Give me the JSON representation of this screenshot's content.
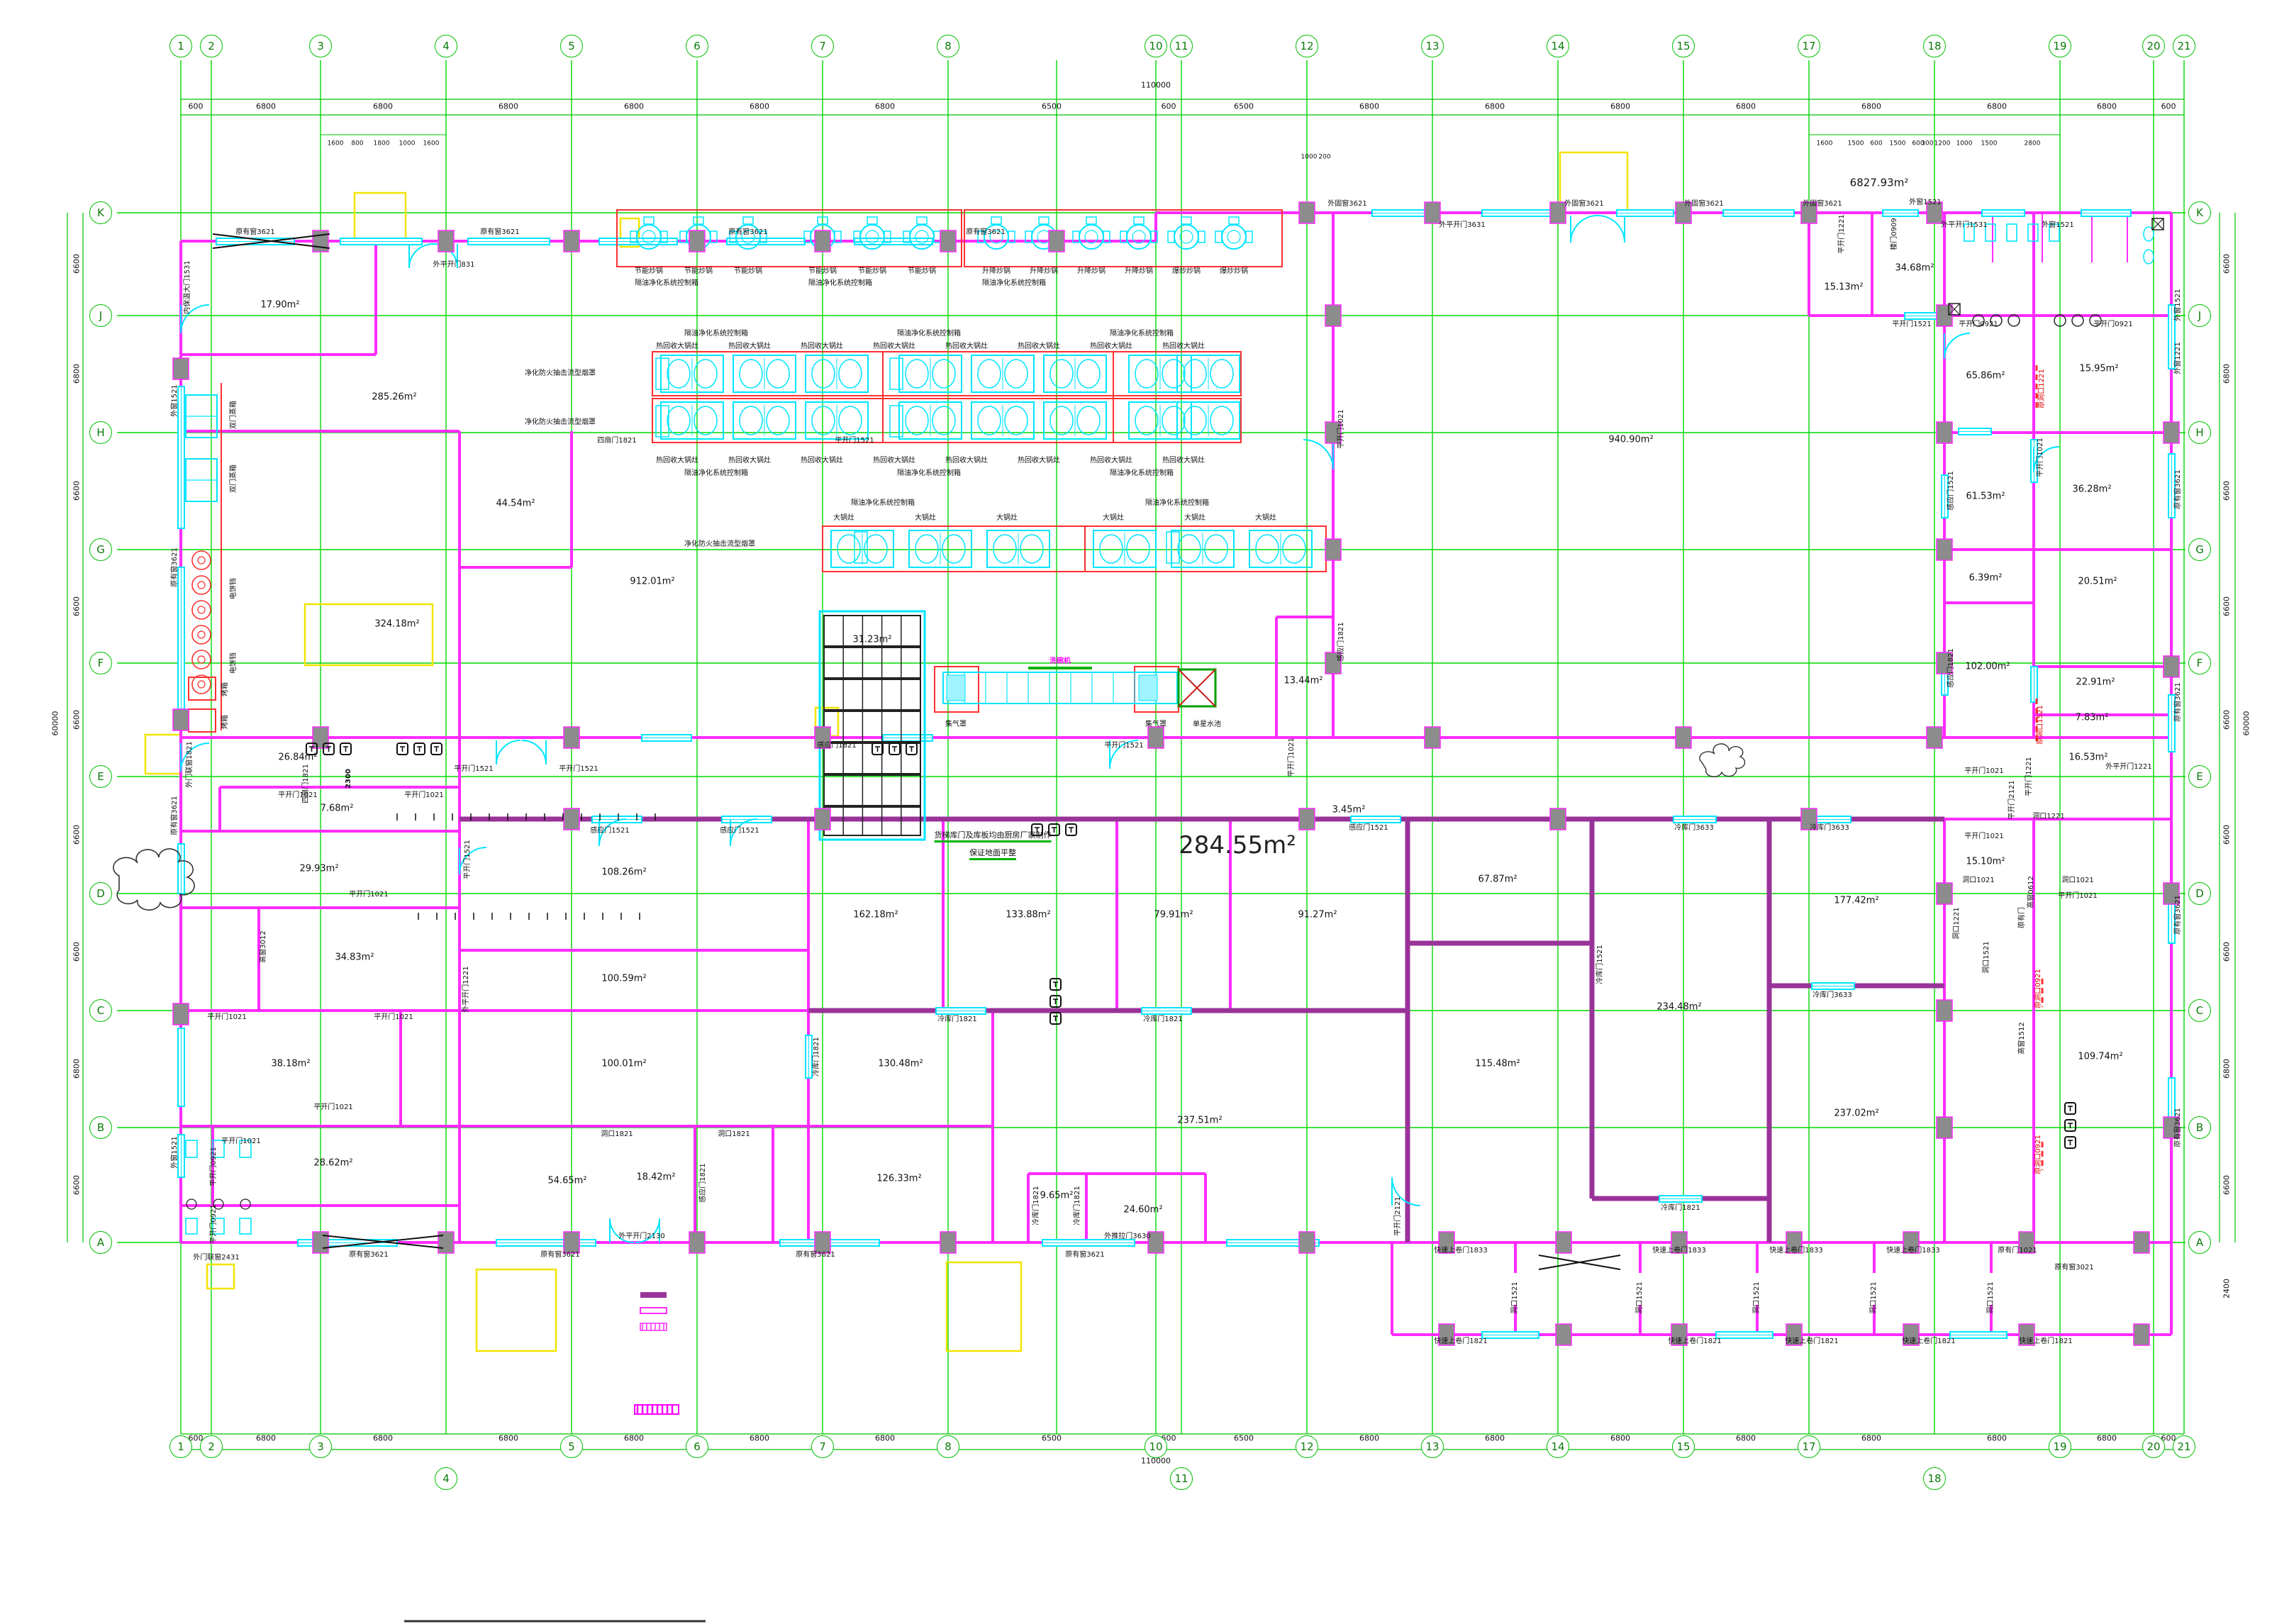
{
  "drawing": {
    "big_area_label": "284.55m²",
    "total_area_label": "6827.93m²",
    "note_line1": "货梯库门及库板均由厨房厂家制作",
    "note_line2": "保证地面平整",
    "overall_width_top": "110000",
    "overall_width_bottom": "110000",
    "overall_height_left": "60000",
    "overall_height_right": "60000",
    "corridor_width": "2300"
  },
  "grid": {
    "top_cols": [
      [
        "1",
        255
      ],
      [
        "2",
        298
      ],
      [
        "3",
        452
      ],
      [
        "4",
        629
      ],
      [
        "5",
        806
      ],
      [
        "6",
        983
      ],
      [
        "7",
        1160
      ],
      [
        "8",
        1337
      ],
      [
        "10",
        1630
      ],
      [
        "11",
        1666
      ],
      [
        "12",
        1843
      ],
      [
        "13",
        2020
      ],
      [
        "14",
        2197
      ],
      [
        "15",
        2374
      ],
      [
        "17",
        2551
      ],
      [
        "18",
        2728
      ],
      [
        "19",
        2905
      ],
      [
        "20",
        3037
      ],
      [
        "21",
        3080
      ]
    ],
    "bottom_cols": [
      [
        "1",
        255,
        2040
      ],
      [
        "2",
        298,
        2040
      ],
      [
        "3",
        452,
        2040
      ],
      [
        "4",
        629,
        2085
      ],
      [
        "5",
        806,
        2040
      ],
      [
        "6",
        983,
        2040
      ],
      [
        "7",
        1160,
        2040
      ],
      [
        "8",
        1337,
        2040
      ],
      [
        "10",
        1630,
        2040
      ],
      [
        "11",
        1666,
        2085
      ],
      [
        "12",
        1843,
        2040
      ],
      [
        "13",
        2020,
        2040
      ],
      [
        "14",
        2197,
        2040
      ],
      [
        "15",
        2374,
        2040
      ],
      [
        "17",
        2551,
        2040
      ],
      [
        "18",
        2728,
        2085
      ],
      [
        "19",
        2905,
        2040
      ],
      [
        "20",
        3037,
        2040
      ],
      [
        "21",
        3080,
        2040
      ]
    ],
    "left_rows": [
      [
        "K",
        300
      ],
      [
        "J",
        445
      ],
      [
        "H",
        610
      ],
      [
        "G",
        775
      ],
      [
        "F",
        935
      ],
      [
        "E",
        1095
      ],
      [
        "D",
        1260
      ],
      [
        "C",
        1425
      ],
      [
        "B",
        1590
      ],
      [
        "A",
        1752
      ]
    ],
    "right_rows": [
      [
        "K",
        300
      ],
      [
        "J",
        445
      ],
      [
        "H",
        610
      ],
      [
        "G",
        775
      ],
      [
        "F",
        935
      ],
      [
        "E",
        1095
      ],
      [
        "D",
        1260
      ],
      [
        "C",
        1425
      ],
      [
        "B",
        1590
      ],
      [
        "A",
        1752
      ]
    ]
  },
  "dims": {
    "top": [
      [
        "600",
        276
      ],
      [
        "6800",
        375
      ],
      [
        "6800",
        540
      ],
      [
        "6800",
        717
      ],
      [
        "6800",
        894
      ],
      [
        "6800",
        1071
      ],
      [
        "6800",
        1248
      ],
      [
        "6500",
        1483
      ],
      [
        "600",
        1648
      ],
      [
        "6500",
        1754
      ],
      [
        "6800",
        1931
      ],
      [
        "6800",
        2108
      ],
      [
        "6800",
        2285
      ],
      [
        "6800",
        2462
      ],
      [
        "6800",
        2639
      ],
      [
        "6800",
        2816
      ],
      [
        "6800",
        2971
      ],
      [
        "600",
        3058
      ]
    ],
    "bottom": [
      [
        "600",
        276
      ],
      [
        "6800",
        375
      ],
      [
        "6800",
        540
      ],
      [
        "6800",
        717
      ],
      [
        "6800",
        894
      ],
      [
        "6800",
        1071
      ],
      [
        "6800",
        1248
      ],
      [
        "6500",
        1483
      ],
      [
        "600",
        1648
      ],
      [
        "6500",
        1754
      ],
      [
        "6800",
        1931
      ],
      [
        "6800",
        2108
      ],
      [
        "6800",
        2285
      ],
      [
        "6800",
        2462
      ],
      [
        "6800",
        2639
      ],
      [
        "6800",
        2816
      ],
      [
        "6800",
        2971
      ],
      [
        "600",
        3058
      ]
    ],
    "sub_top_left": [
      [
        "1600",
        473
      ],
      [
        "800",
        504
      ],
      [
        "1800",
        538
      ],
      [
        "1000",
        574
      ],
      [
        "1600",
        608
      ]
    ],
    "sub_top_right": [
      [
        "1600",
        2573
      ],
      [
        "1500",
        2617
      ],
      [
        "600",
        2646
      ],
      [
        "1500",
        2676
      ],
      [
        "600",
        2705
      ],
      [
        "300",
        2718
      ],
      [
        "1200",
        2739
      ],
      [
        "1000",
        2770
      ],
      [
        "1500",
        2805
      ],
      [
        "2800",
        2866
      ]
    ],
    "sub_top_mid": [
      [
        "1000",
        1846
      ],
      [
        "200",
        1868
      ]
    ],
    "left": [
      [
        "6600",
        372
      ],
      [
        "6800",
        527
      ],
      [
        "6600",
        692
      ],
      [
        "6600",
        855
      ],
      [
        "6600",
        1015
      ],
      [
        "6600",
        1177
      ],
      [
        "6600",
        1342
      ],
      [
        "6800",
        1507
      ],
      [
        "6600",
        1671
      ]
    ],
    "right": [
      [
        "6600",
        372
      ],
      [
        "6800",
        527
      ],
      [
        "6600",
        692
      ],
      [
        "6600",
        855
      ],
      [
        "6600",
        1015
      ],
      [
        "6600",
        1177
      ],
      [
        "6600",
        1342
      ],
      [
        "6800",
        1507
      ],
      [
        "6600",
        1671
      ],
      [
        "2400",
        1817
      ]
    ]
  },
  "areas": [
    [
      "17.90m²",
      395,
      430
    ],
    [
      "285.26m²",
      556,
      560
    ],
    [
      "912.01m²",
      920,
      820
    ],
    [
      "44.54m²",
      727,
      710
    ],
    [
      "324.18m²",
      560,
      880
    ],
    [
      "31.23m²",
      1230,
      902
    ],
    [
      "940.90m²",
      2300,
      620
    ],
    [
      "13.44m²",
      1838,
      960
    ],
    [
      "3.45m²",
      1902,
      1142
    ],
    [
      "15.13m²",
      2600,
      405
    ],
    [
      "34.68m²",
      2700,
      378
    ],
    [
      "15.95m²",
      2960,
      520
    ],
    [
      "65.86m²",
      2800,
      530
    ],
    [
      "36.28m²",
      2950,
      690
    ],
    [
      "61.53m²",
      2800,
      700
    ],
    [
      "20.51m²",
      2958,
      820
    ],
    [
      "6.39m²",
      2800,
      815
    ],
    [
      "102.00m²",
      2803,
      940
    ],
    [
      "22.91m²",
      2955,
      962
    ],
    [
      "7.83m²",
      2950,
      1012
    ],
    [
      "16.53m²",
      2945,
      1068
    ],
    [
      "15.10m²",
      2800,
      1215
    ],
    [
      "26.84m²",
      420,
      1068
    ],
    [
      "7.68m²",
      475,
      1140
    ],
    [
      "29.93m²",
      450,
      1225
    ],
    [
      "34.83m²",
      500,
      1350
    ],
    [
      "38.18m²",
      410,
      1500
    ],
    [
      "28.62m²",
      470,
      1640
    ],
    [
      "54.65m²",
      800,
      1665
    ],
    [
      "18.42m²",
      925,
      1660
    ],
    [
      "108.26m²",
      880,
      1230
    ],
    [
      "100.59m²",
      880,
      1380
    ],
    [
      "100.01m²",
      880,
      1500
    ],
    [
      "162.18m²",
      1235,
      1290
    ],
    [
      "133.88m²",
      1450,
      1290
    ],
    [
      "79.91m²",
      1655,
      1290
    ],
    [
      "91.27m²",
      1858,
      1290
    ],
    [
      "67.87m²",
      2112,
      1240
    ],
    [
      "115.48m²",
      2112,
      1500
    ],
    [
      "234.48m²",
      2368,
      1420
    ],
    [
      "177.42m²",
      2618,
      1270
    ],
    [
      "237.02m²",
      2618,
      1570
    ],
    [
      "237.51m²",
      1692,
      1580
    ],
    [
      "130.48m²",
      1270,
      1500
    ],
    [
      "126.33m²",
      1268,
      1662
    ],
    [
      "9.65m²",
      1490,
      1686
    ],
    [
      "24.60m²",
      1612,
      1706
    ],
    [
      "109.74m²",
      2962,
      1490
    ]
  ],
  "doors": [
    [
      "原有窗3621",
      360,
      328
    ],
    [
      "原有窗3621",
      705,
      328
    ],
    [
      "原有窗3621",
      1055,
      328
    ],
    [
      "原有窗3621",
      1390,
      328
    ],
    [
      "外平开门831",
      640,
      374
    ],
    [
      "外固窗3621",
      1900,
      288
    ],
    [
      "外固窗3621",
      2234,
      288
    ],
    [
      "外固窗3621",
      2403,
      288
    ],
    [
      "外固窗3621",
      2570,
      288
    ],
    [
      "外平开门3631",
      2062,
      318
    ],
    [
      "外窗1521",
      2715,
      286
    ],
    [
      "外平开门1531",
      2770,
      318
    ],
    [
      "外窗1521",
      2902,
      318
    ],
    [
      "外窗1521",
      3072,
      430,
      -90
    ],
    [
      "外窗1221",
      3072,
      505,
      -90
    ],
    [
      "原有窗3621",
      3072,
      690,
      -90
    ],
    [
      "原有窗3621",
      3072,
      990,
      -90
    ],
    [
      "原有窗3621",
      3072,
      1290,
      -90
    ],
    [
      "原有窗3621",
      3072,
      1590,
      -90
    ],
    [
      "内保温大门1531",
      265,
      405,
      -90
    ],
    [
      "外窗1521",
      247,
      565,
      -90
    ],
    [
      "原有窗3621",
      247,
      800,
      -90
    ],
    [
      "原有窗3621",
      247,
      1150,
      -90
    ],
    [
      "外窗1521",
      247,
      1625,
      -90
    ],
    [
      "外门联窗1821",
      268,
      1078,
      -90
    ],
    [
      "平开门0921",
      302,
      1645,
      -90
    ],
    [
      "平开门0921",
      302,
      1726,
      -90
    ],
    [
      "四扇门1821",
      432,
      1105,
      -90
    ],
    [
      "平开门1521",
      668,
      1085
    ],
    [
      "平开门1521",
      816,
      1085
    ],
    [
      "感应门1821",
      1180,
      1052
    ],
    [
      "平开门1521",
      1585,
      1052
    ],
    [
      "平开门1021",
      1822,
      1068,
      -90
    ],
    [
      "感应门1521",
      860,
      1172
    ],
    [
      "感应门1521",
      1043,
      1172
    ],
    [
      "感应门1521",
      1930,
      1168
    ],
    [
      "四扇门1821",
      870,
      622
    ],
    [
      "平开门1521",
      1205,
      622
    ],
    [
      "平开门1521",
      660,
      1212,
      -90
    ],
    [
      "平开门1021",
      1892,
      605,
      -90
    ],
    [
      "感应门1821",
      1892,
      905,
      -90
    ],
    [
      "平开门1021",
      420,
      1122
    ],
    [
      "平开门1021",
      598,
      1122
    ],
    [
      "平开门1021",
      320,
      1435
    ],
    [
      "平开门1021",
      555,
      1435
    ],
    [
      "平开门1021",
      470,
      1562
    ],
    [
      "平开门1021",
      340,
      1610
    ],
    [
      "高窗3012",
      372,
      1335,
      -90
    ],
    [
      "外平开门1221",
      658,
      1395,
      -90
    ],
    [
      "平开门1021",
      520,
      1262
    ],
    [
      "洞口1821",
      870,
      1600
    ],
    [
      "洞口1821",
      1035,
      1600
    ],
    [
      "感应门1821",
      992,
      1668,
      -90
    ],
    [
      "冷库门1821",
      1350,
      1438
    ],
    [
      "冷库门1821",
      1640,
      1438
    ],
    [
      "冷库门1821",
      1152,
      1490,
      -90
    ],
    [
      "冷库门1521",
      2257,
      1360,
      -90
    ],
    [
      "冷库门3633",
      2389,
      1168
    ],
    [
      "冷库门3633",
      2580,
      1168
    ],
    [
      "冷库门3633",
      2584,
      1404
    ],
    [
      "冷库门1821",
      2370,
      1704
    ],
    [
      "冷库门1821",
      1462,
      1700,
      -90
    ],
    [
      "冷库门1821",
      1520,
      1700,
      -90
    ],
    [
      "外推拉门3630",
      1590,
      1744
    ],
    [
      "平开门2121",
      1972,
      1715,
      -90
    ],
    [
      "平开门1521",
      2696,
      458
    ],
    [
      "平开门1221",
      2598,
      330,
      -90
    ],
    [
      "楼门0909",
      2672,
      330,
      -90
    ],
    [
      "平开门0921",
      2790,
      458
    ],
    [
      "平开门0921",
      2980,
      458
    ],
    [
      "感应门1521",
      2752,
      692,
      -90
    ],
    [
      "感应门1821",
      2752,
      942,
      -90
    ],
    [
      "原洞口1221",
      2880,
      548,
      -90,
      "r"
    ],
    [
      "平开门1021",
      2878,
      645,
      -90
    ],
    [
      "原洞口1521",
      2878,
      1022,
      -90,
      "r"
    ],
    [
      "平开门1021",
      2798,
      1088
    ],
    [
      "洞口1221",
      2889,
      1152
    ],
    [
      "外平开门1221",
      3002,
      1082
    ],
    [
      "平开门1221",
      2862,
      1095,
      -90
    ],
    [
      "平开门2121",
      2838,
      1128,
      -90
    ],
    [
      "洞口1021",
      2790,
      1242
    ],
    [
      "洞口1021",
      2930,
      1242
    ],
    [
      "平开门1021",
      2930,
      1264
    ],
    [
      "平开门1021",
      2798,
      1180
    ],
    [
      "洞口1221",
      2760,
      1302,
      -90
    ],
    [
      "洞口1521",
      2802,
      1350,
      -90
    ],
    [
      "高窗0612",
      2865,
      1258,
      -90
    ],
    [
      "高窗1512",
      2852,
      1464,
      -90
    ],
    [
      "原有门",
      2852,
      1294,
      -90
    ],
    [
      "原洞口0921",
      2875,
      1394,
      -90,
      "r"
    ],
    [
      "原洞口0921",
      2875,
      1628,
      -90,
      "r"
    ],
    [
      "原有窗3621",
      520,
      1770
    ],
    [
      "原有窗3621",
      790,
      1770
    ],
    [
      "原有窗3621",
      1150,
      1770
    ],
    [
      "原有窗3621",
      1530,
      1770
    ],
    [
      "外门联窗2431",
      305,
      1774
    ],
    [
      "外平开门2130",
      905,
      1744
    ],
    [
      "快速上卷门1833",
      2060,
      1764
    ],
    [
      "快速上卷门1833",
      2368,
      1764
    ],
    [
      "快速上卷门1833",
      2533,
      1764
    ],
    [
      "快速上卷门1833",
      2698,
      1764
    ],
    [
      "原有门1021",
      2845,
      1764
    ],
    [
      "原有窗3021",
      2925,
      1788
    ],
    [
      "快速上卷门1821",
      2060,
      1892
    ],
    [
      "快速上卷门1821",
      2390,
      1892
    ],
    [
      "快速上卷门1821",
      2555,
      1892
    ],
    [
      "快速上卷门1821",
      2720,
      1892
    ],
    [
      "快速上卷门1821",
      2885,
      1892
    ],
    [
      "洞口1521",
      2137,
      1830,
      -90
    ],
    [
      "洞口1521",
      2313,
      1830,
      -90
    ],
    [
      "洞口1521",
      2478,
      1830,
      -90
    ],
    [
      "洞口1521",
      2643,
      1830,
      -90
    ],
    [
      "洞口1521",
      2808,
      1830,
      -90
    ]
  ],
  "equipment_labels": [
    [
      "节能炒锅",
      915,
      383
    ],
    [
      "节能炒锅",
      985,
      383
    ],
    [
      "节能炒锅",
      1055,
      383
    ],
    [
      "节能炒锅",
      1160,
      383
    ],
    [
      "节能炒锅",
      1230,
      383
    ],
    [
      "节能炒锅",
      1300,
      383
    ],
    [
      "升降炒锅",
      1405,
      383
    ],
    [
      "升降炒锅",
      1472,
      383
    ],
    [
      "升降炒锅",
      1539,
      383
    ],
    [
      "升降炒锅",
      1606,
      383
    ],
    [
      "爆炒炒锅",
      1673,
      383
    ],
    [
      "爆炒炒锅",
      1740,
      383
    ],
    [
      "隔油净化系统控制箱",
      940,
      400
    ],
    [
      "隔油净化系统控制箱",
      1185,
      400
    ],
    [
      "隔油净化系统控制箱",
      1430,
      400
    ],
    [
      "隔油净化系统控制箱",
      1010,
      471
    ],
    [
      "隔油净化系统控制箱",
      1310,
      471
    ],
    [
      "隔油净化系统控制箱",
      1610,
      471
    ],
    [
      "隔油净化系统控制箱",
      1010,
      668
    ],
    [
      "隔油净化系统控制箱",
      1310,
      668
    ],
    [
      "隔油净化系统控制箱",
      1610,
      668
    ],
    [
      "隔油净化系统控制箱",
      1245,
      710
    ],
    [
      "隔油净化系统控制箱",
      1660,
      710
    ],
    [
      "热回收大锅灶",
      955,
      489
    ],
    [
      "热回收大锅灶",
      1057,
      489
    ],
    [
      "热回收大锅灶",
      1159,
      489
    ],
    [
      "热回收大锅灶",
      1261,
      489
    ],
    [
      "热回收大锅灶",
      1363,
      489
    ],
    [
      "热回收大锅灶",
      1465,
      489
    ],
    [
      "热回收大锅灶",
      1567,
      489
    ],
    [
      "热回收大锅灶",
      1669,
      489
    ],
    [
      "热回收大锅灶",
      955,
      650
    ],
    [
      "热回收大锅灶",
      1057,
      650
    ],
    [
      "热回收大锅灶",
      1159,
      650
    ],
    [
      "热回收大锅灶",
      1261,
      650
    ],
    [
      "热回收大锅灶",
      1363,
      650
    ],
    [
      "热回收大锅灶",
      1465,
      650
    ],
    [
      "热回收大锅灶",
      1567,
      650
    ],
    [
      "热回收大锅灶",
      1669,
      650
    ],
    [
      "净化防火抽击流型烟罩",
      790,
      527
    ],
    [
      "净化防火抽击流型烟罩",
      790,
      596
    ],
    [
      "净化防火抽击流型烟罩",
      1015,
      768
    ],
    [
      "大锅灶",
      1190,
      731
    ],
    [
      "大锅灶",
      1305,
      731
    ],
    [
      "大锅灶",
      1420,
      731
    ],
    [
      "大锅灶",
      1570,
      731
    ],
    [
      "大锅灶",
      1685,
      731
    ],
    [
      "大锅灶",
      1785,
      731
    ],
    [
      "洗碗机",
      1495,
      933,
      0,
      "m"
    ],
    [
      "集气罩",
      1348,
      1022
    ],
    [
      "集气罩",
      1630,
      1022
    ],
    [
      "单星水池",
      1702,
      1022
    ],
    [
      "双门蒸箱",
      330,
      585,
      -90
    ],
    [
      "双门蒸箱",
      330,
      675,
      -90
    ],
    [
      "电饼铛",
      330,
      830,
      -90
    ],
    [
      "电饼铛",
      330,
      935,
      -90
    ],
    [
      "烤箱",
      318,
      972,
      -90
    ],
    [
      "烤箱",
      318,
      1018,
      -90
    ]
  ]
}
